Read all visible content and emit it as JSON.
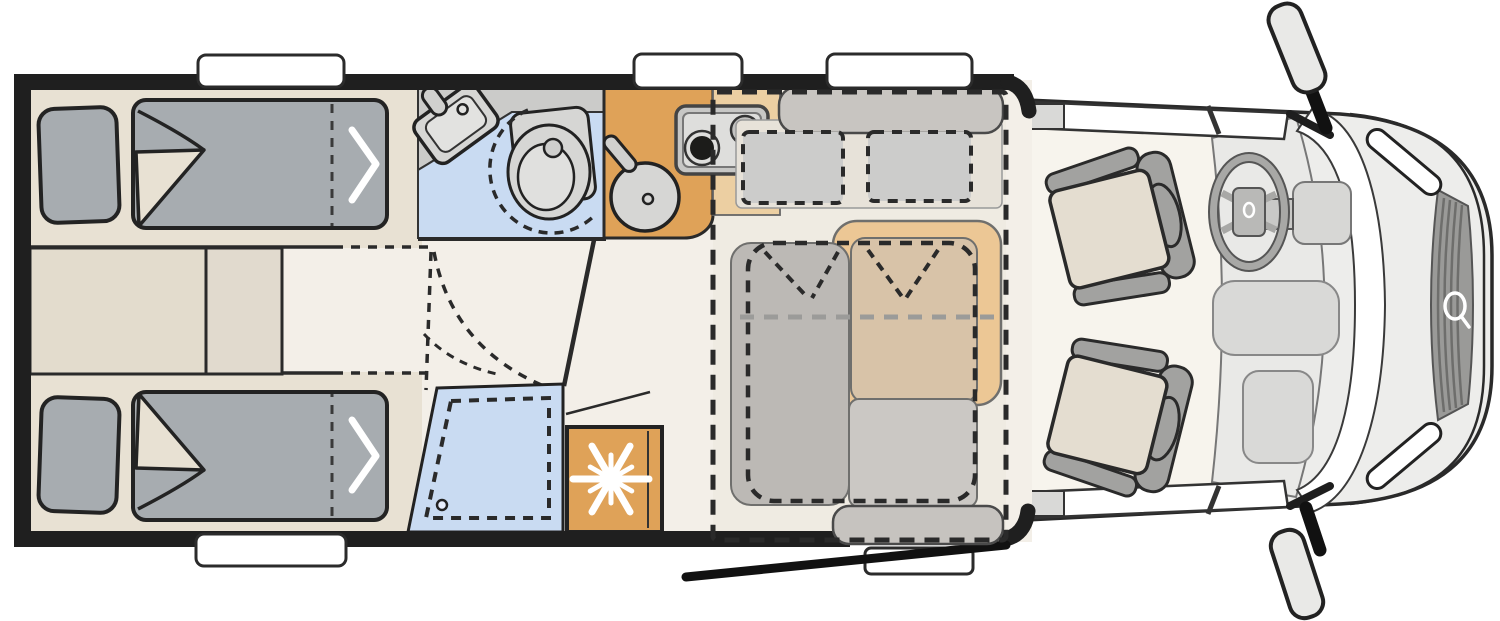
{
  "meta": {
    "title": "Motorhome floor plan (top view)",
    "diagram_type": "vehicle-floorplan",
    "orientation": "cab at right, rear at left"
  },
  "colors": {
    "wall": "#1f1f1f",
    "outline": "#2a2a2a",
    "floor": "#f3efe8",
    "lounge_floor": "#efebe2",
    "platform": "#e8e1d3",
    "cabinet": "#e3dccd",
    "cabinet2": "#e1dace",
    "mattress": "#a7acb0",
    "bath_counter": "#cbcbc9",
    "bath_floor": "#c9dbf2",
    "fixture": "#d6d6d4",
    "fixture_light": "#e2e2e0",
    "orange": "#dfa258",
    "orange_light": "#eccfa2",
    "lounge_orange": "#ecc795",
    "lounge_tan": "#d8c3a8",
    "bench": "#c8c5c1",
    "bench_seat": "#e7e2d9",
    "headrest": "#cccccb",
    "table": "#bcb9b5",
    "seat_base": "#cbc8c4",
    "bottom_bench": "#c6c3bf",
    "white": "#ffffff",
    "cab_body": "#ededeb",
    "cab_floor": "#f7f4ed",
    "dash_panel": "#e9e9e7",
    "console": "#d9d9d7",
    "grille": "#9a9a98",
    "grille_stripe": "#6e6e6c",
    "cab_seat": "#e4ddd0",
    "seat_frame": "#a2a2a0",
    "mirror_blade": "#e9e9e7",
    "snowflake": "#ffffff",
    "stove_body": "#c7c7c5",
    "stove_top": "#dededc",
    "burner_dark": "#1c1c1a"
  },
  "rooms": {
    "rear_bedroom": {
      "name": "Rear twin bedroom",
      "features": [
        "single bed top",
        "single bed bottom",
        "pillows",
        "folded duvets",
        "bed extension (dashed)",
        "cabinets between beds"
      ]
    },
    "bathroom": {
      "name": "Washroom",
      "features": [
        "corner washbasin with tap",
        "swivel toilet (dashed swing)",
        "door swing arc (dashed)"
      ]
    },
    "shower": {
      "name": "Shower cubicle",
      "features": [
        "dashed tray outline",
        "drain"
      ]
    },
    "kitchen": {
      "name": "Kitchenette",
      "features": [
        "round sink with tap",
        "two-burner hob",
        "worktop",
        "refrigerator with snowflake symbol"
      ]
    },
    "lounge": {
      "name": "Half-dinette lounge",
      "features": [
        "forward-facing bench with two dashed headrests",
        "side bench (orange)",
        "table",
        "drop-down bed outline (dashed)",
        "entry bench/step"
      ]
    },
    "cab": {
      "name": "Driver cab",
      "features": [
        "driver swivel seat",
        "passenger swivel seat",
        "steering wheel with logo",
        "dashboard",
        "center console",
        "glovebox",
        "windshield",
        "grille with logo",
        "headlights",
        "two exterior mirrors",
        "side window bands"
      ]
    }
  },
  "openings": {
    "windows_top_wall": 3,
    "windows_bottom_wall": 1,
    "entry_door": "open door leaf drawn swung outward, bottom right of habitation",
    "entry_step": 1
  }
}
